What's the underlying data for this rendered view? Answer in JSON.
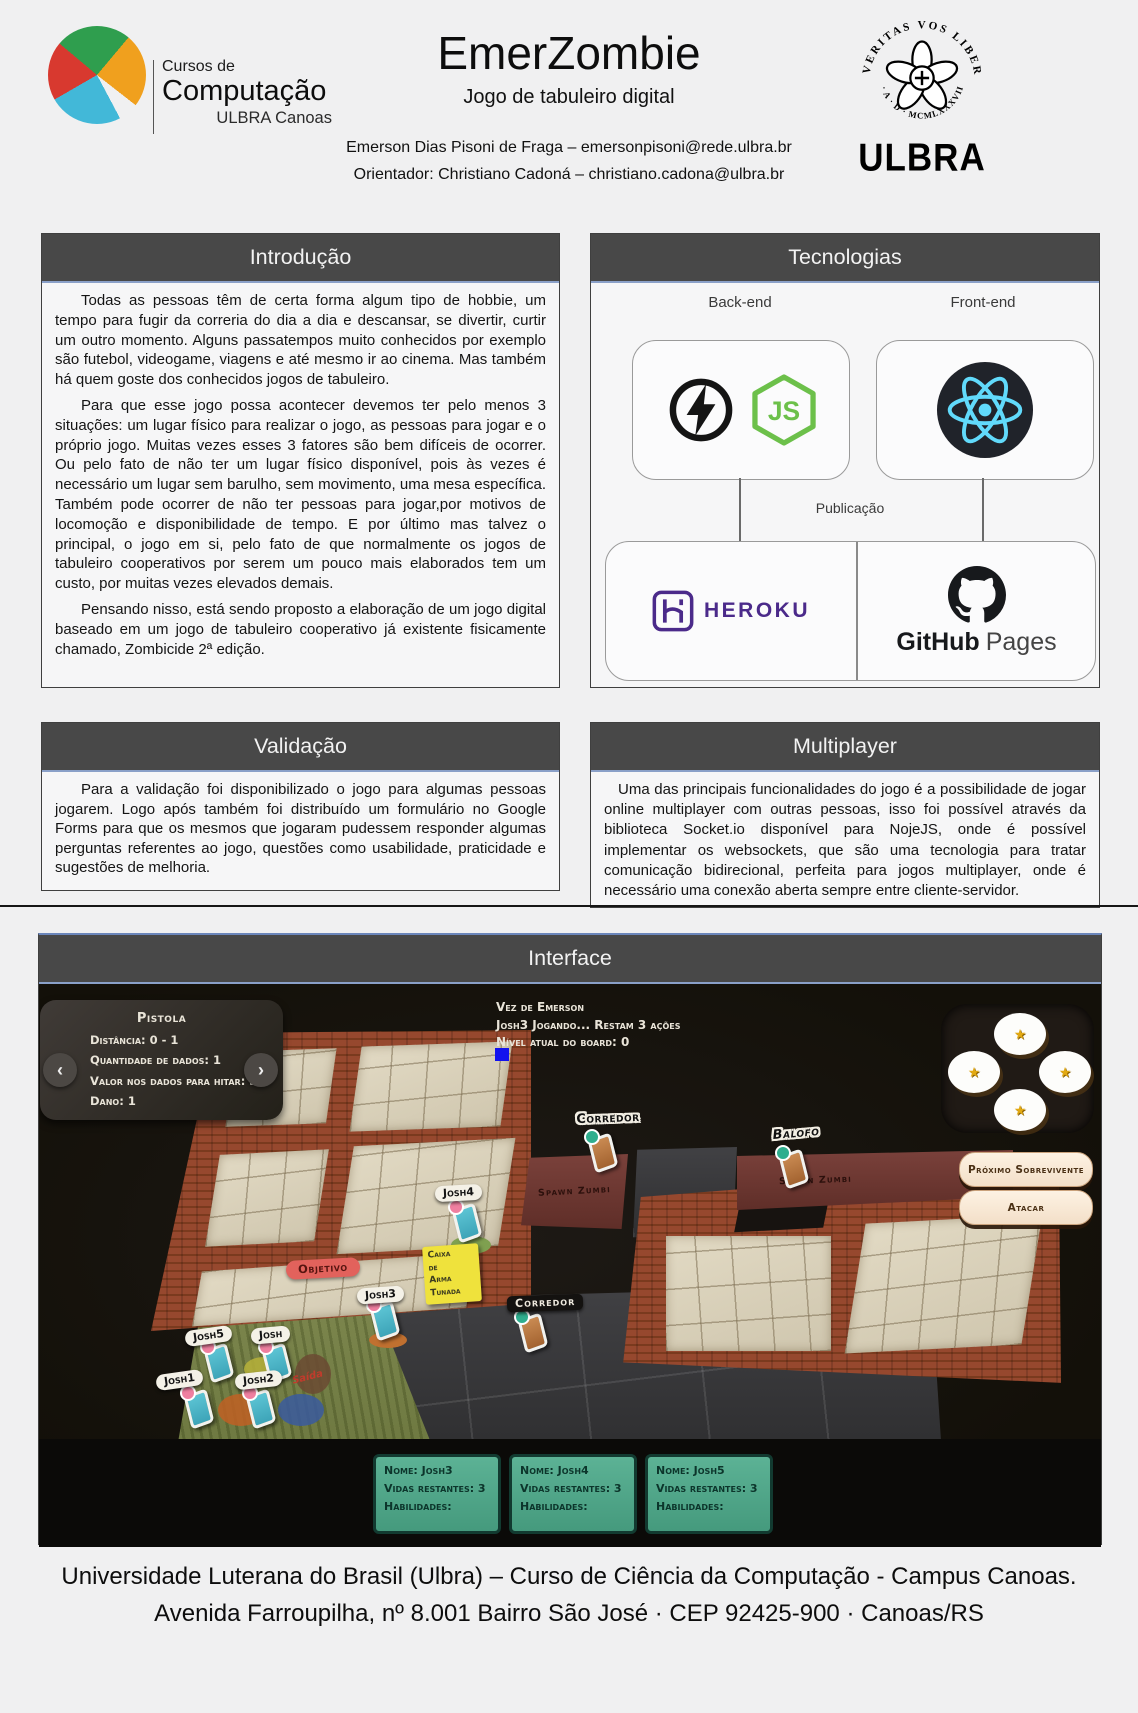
{
  "header": {
    "logo": {
      "line1": "Cursos de",
      "line2": "Computação",
      "line3": "ULBRA Canoas"
    },
    "title": "EmerZombie",
    "subtitle": "Jogo de tabuleiro digital",
    "author_line": "Emerson Dias Pisoni de Fraga – emersonpisoni@rede.ulbra.br",
    "advisor_line": "Orientador: Christiano Cadoná – christiano.cadona@ulbra.br",
    "seal": {
      "arc_top": "VERITAS VOS LIBERABIT",
      "arc_bottom": "· A · D · MCMLXXXVIII ·",
      "wordmark": "ULBRA"
    }
  },
  "sections": {
    "introducao": {
      "title": "Introdução",
      "paragraphs": [
        "Todas as pessoas têm de certa forma algum tipo de hobbie, um tempo para fugir da correria do dia a dia e descansar, se divertir, curtir um outro momento. Alguns passatempos muito conhecidos por exemplo são futebol, videogame, viagens e até mesmo ir ao cinema. Mas também há quem goste dos conhecidos jogos de tabuleiro.",
        "Para que esse jogo possa acontecer devemos ter pelo menos 3 situações: um lugar físico para realizar o jogo, as pessoas para jogar e o próprio jogo. Muitas vezes esses 3 fatores são bem difíceis de ocorrer. Ou pelo fato de não ter um lugar físico disponível, pois às vezes é necessário um lugar sem barulho, sem movimento, uma mesa específica. Também pode ocorrer de não ter pessoas para jogar,por motivos de locomoção e disponibilidade de tempo. E por último mas talvez o principal, o jogo em si, pelo fato de que normalmente os jogos de tabuleiro cooperativos por serem um pouco mais elaborados tem um custo, por muitas vezes elevados demais.",
        "Pensando nisso, está sendo proposto a elaboração de um jogo digital baseado em um jogo de tabuleiro cooperativo já existente fisicamente chamado, Zombicide 2ª edição."
      ]
    },
    "tecnologias": {
      "title": "Tecnologias",
      "backend_label": "Back-end",
      "frontend_label": "Front-end",
      "publicacao_label": "Publicação",
      "node_text": "JS",
      "heroku_text": "HEROKU",
      "github_text_bold": "GitHub",
      "github_text_light": "Pages"
    },
    "validacao": {
      "title": "Validação",
      "paragraphs": [
        "Para a validação foi disponibilizado o jogo para algumas pessoas jogarem. Logo após também foi distribuído um formulário no Google Forms para que os mesmos que jogaram pudessem responder algumas perguntas referentes ao jogo, questões como usabilidade, praticidade e sugestões de melhoria."
      ]
    },
    "multiplayer": {
      "title": "Multiplayer",
      "paragraphs": [
        "Uma das principais funcionalidades do jogo é a possibilidade de jogar online multiplayer com outras pessoas, isso foi possível através da biblioteca Socket.io disponível para NojeJS, onde é possível implementar os websockets, que são uma tecnologia para tratar comunicação bidirecional, perfeita para jogos multiplayer, onde é necessário uma conexão aberta sempre entre cliente-servidor."
      ]
    },
    "interface_sec": {
      "title": "Interface"
    }
  },
  "game": {
    "weapon_card": {
      "name": "Pistola",
      "lines": [
        "Distância: 0 - 1",
        "Quantidade de dados: 1",
        "Valor nos dados para hitar: 3",
        "Dano: 1"
      ],
      "prev_icon": "‹",
      "next_icon": "›"
    },
    "status": {
      "line1": "Vez de Emerson",
      "line2": "Josh3 Jogando... Restam 3 ações",
      "line3": "Nível atual do board: 0"
    },
    "dice": {
      "glyph": "★"
    },
    "actions": {
      "next_survivor": "Próximo Sobrevivente",
      "attack": "Atacar"
    },
    "board": {
      "corredor_top": "Corredor",
      "balofo": "Balofo",
      "spawn1": "Spawn Zumbi",
      "spawn2": "Spawn Zumbi",
      "objetivo": "Objetivo",
      "corredor_center": "Corredor",
      "saida": "Saída",
      "caixa_lines": [
        "Caixa",
        "de",
        "Arma",
        "Tunada"
      ],
      "tokens": {
        "josh": "Josh",
        "josh1": "Josh1",
        "josh2": "Josh2",
        "josh3": "Josh3",
        "josh4": "Josh4",
        "josh5": "Josh5"
      }
    },
    "player_cards": [
      {
        "nome": "Nome: Josh3",
        "vidas": "Vidas restantes: 3",
        "habilidades": "Habilidades:"
      },
      {
        "nome": "Nome: Josh4",
        "vidas": "Vidas restantes: 3",
        "habilidades": "Habilidades:"
      },
      {
        "nome": "Nome: Josh5",
        "vidas": "Vidas restantes: 3",
        "habilidades": "Habilidades:"
      }
    ]
  },
  "footer": {
    "line1": "Universidade Luterana do Brasil (Ulbra) – Curso de Ciência da Computação - Campus Canoas.",
    "line2": "Avenida Farroupilha, nº 8.001 Bairro São José · CEP 92425-900 · Canoas/RS"
  },
  "colors": {
    "section_header": "#484848",
    "accent_line": "#8aa0c8",
    "spawn_red": "#6e3a33",
    "card_teal": "#55a88b",
    "button_cream": "#f7e8d6",
    "node_green": "#6cc04a",
    "react_cyan": "#61dafb",
    "heroku_purple": "#4b2a8a",
    "blue_marker": "#1212ee"
  }
}
